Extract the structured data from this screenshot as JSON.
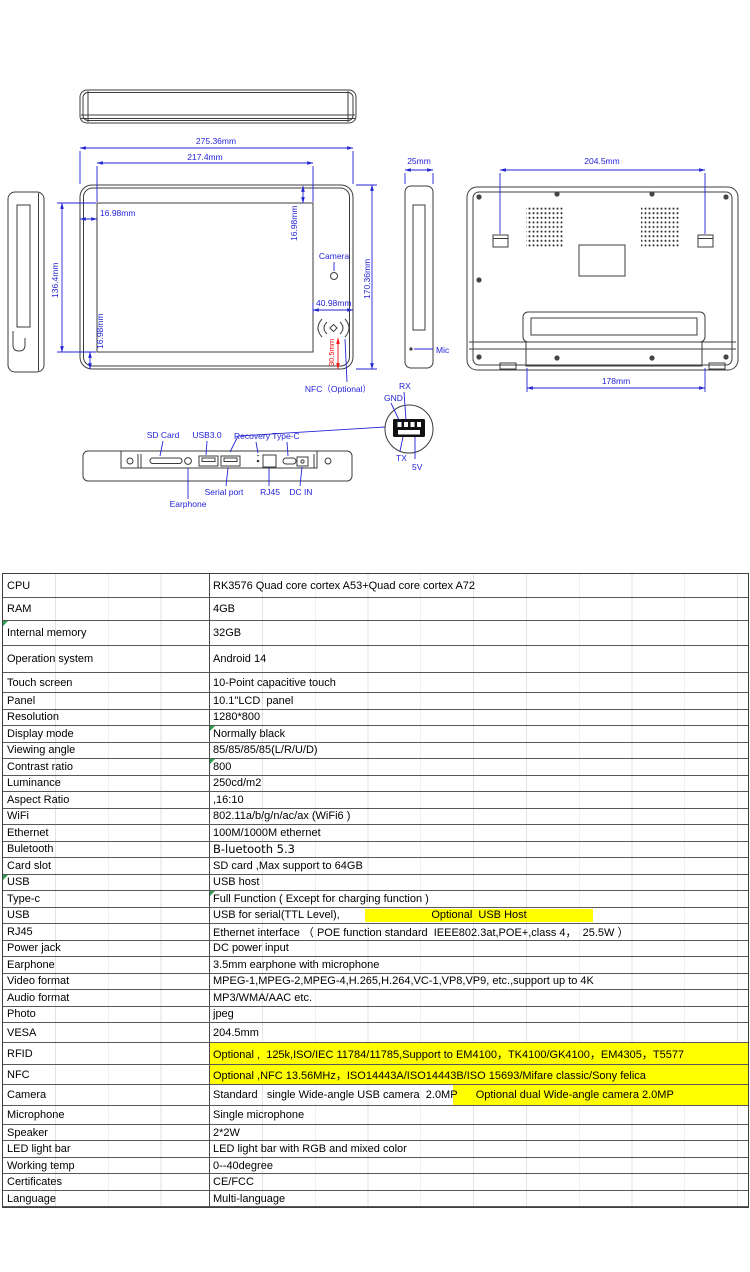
{
  "colors": {
    "dimension_blue": "#2323d8",
    "dimension_red": "#ee1111",
    "highlight_yellow": "#ffff00",
    "indicator_green": "#2f9e4f",
    "line_dark": "#3c3c3c"
  },
  "drawings": {
    "labels": {
      "dim_275": "275.36mm",
      "dim_217": "217.4mm",
      "dim_1698_a": "16.98mm",
      "dim_1698_b": "16.98mm",
      "dim_1698_c": "16.98mm",
      "dim_1364": "136.4mm",
      "dim_17036": "170.36mm",
      "camera": "Camera",
      "dim_4098": "40.98mm",
      "dim_305": "30.5mm",
      "nfc": "NFC（Optional）",
      "dim_25": "25mm",
      "dim_2045": "204.5mm",
      "dim_178": "178mm",
      "mic": "Mic",
      "rx": "RX",
      "gnd": "GND",
      "tx": "TX",
      "v5": "5V",
      "sd_card": "SD Card",
      "usb30": "USB3.0",
      "recovery": "Recovery",
      "type_c": "Type-C",
      "earphone": "Earphone",
      "serial_port": "Serial port",
      "rj45": "RJ45",
      "dc_in": "DC IN"
    }
  },
  "table": {
    "rows": [
      {
        "label": "CPU",
        "value": "RK3576 Quad core cortex A53+Quad core cortex A72",
        "h": 24
      },
      {
        "label": "RAM",
        "value": "4GB",
        "h": 23
      },
      {
        "label": "Internal memory",
        "value": "32GB",
        "h": 25,
        "green": "label"
      },
      {
        "label": "Operation system",
        "value": "Android 14",
        "h": 27
      },
      {
        "label": "Touch screen",
        "value": "10-Point capacitive touch",
        "h": 20
      },
      {
        "label": "Panel",
        "value": "10.1\"LCD  panel",
        "h": 16.5
      },
      {
        "label": "Resolution",
        "value": "1280*800",
        "h": 16.5
      },
      {
        "label": "Display mode",
        "value": "Normally black",
        "h": 16.5,
        "green": "value"
      },
      {
        "label": "Viewing angle",
        "value": "85/85/85/85(L/R/U/D)",
        "h": 16.5
      },
      {
        "label": "Contrast ratio",
        "value": "800",
        "h": 16.5,
        "green": "value"
      },
      {
        "label": "Luminance",
        "value": "250cd/m2",
        "h": 16.5
      },
      {
        "label": "Aspect Ratio",
        "value": ",16:10",
        "h": 16.5
      },
      {
        "label": "WiFi",
        "value": "802.11a/b/g/n/ac/ax (WiFi6 )",
        "h": 16.5
      },
      {
        "label": "Ethernet",
        "value": "100M/1000M ethernet",
        "h": 16.5
      },
      {
        "label": "Buletooth",
        "value": "B-luetooth 5.3",
        "h": 16.5,
        "alt": true
      },
      {
        "label": "Card slot",
        "value": "SD card ,Max support to 64GB",
        "h": 16.5
      },
      {
        "label": "USB",
        "value": "USB host",
        "h": 16.5,
        "green": "label"
      },
      {
        "label": "Type-c",
        "value": "Full Function ( Except for charging function )",
        "h": 16.5,
        "green": "value"
      },
      {
        "label": "USB",
        "value": "USB for serial(TTL Level),",
        "h": 16.5,
        "highlight": {
          "type": "block",
          "left": 155,
          "width": 228
        },
        "value2": "Optional  USB Host"
      },
      {
        "label": "RJ45",
        "value": "Ethernet interface （ POE function standard  IEEE802.3at,POE+,class 4，  25.5W ）",
        "h": 16.5
      },
      {
        "label": "Power jack",
        "value": "DC power input",
        "h": 16.5
      },
      {
        "label": "Earphone",
        "value": "3.5mm earphone with microphone",
        "h": 16.5
      },
      {
        "label": "Video format",
        "value": "MPEG-1,MPEG-2,MPEG-4,H.265,H.264,VC-1,VP8,VP9, etc.,support up to 4K",
        "h": 16.5
      },
      {
        "label": "Audio format",
        "value": "MP3/WMA/AAC etc.",
        "h": 16.5
      },
      {
        "label": "Photo",
        "value": "jpeg",
        "h": 16.5
      },
      {
        "label": "VESA",
        "value": "204.5mm",
        "h": 20
      },
      {
        "label": "RFID",
        "value": "Optional ,  125k,ISO/IEC 11784/11785,Support to EM4100，TK4100/GK4100，EM4305，T5577",
        "h": 22,
        "highlight": "full"
      },
      {
        "label": "NFC",
        "value": "Optional ,NFC 13.56MHz，ISO14443A/ISO14443B/ISO 15693/Mifare classic/Sony felica",
        "h": 20,
        "highlight": "full"
      },
      {
        "label": "Camera",
        "value": "Standard   single Wide-angle USB camera  2.0MP",
        "h": 21,
        "highlight": {
          "type": "tail",
          "left": 243
        },
        "value2": "Optional dual Wide-angle camera 2.0MP"
      },
      {
        "label": "Microphone",
        "value": "Single microphone",
        "h": 19
      },
      {
        "label": "Speaker",
        "value": "2*2W",
        "h": 16
      },
      {
        "label": "LED light bar",
        "value": "LED light bar with RGB and mixed color",
        "h": 17
      },
      {
        "label": "Working temp",
        "value": "0--40degree",
        "h": 16
      },
      {
        "label": "Certificates",
        "value": "CE/FCC",
        "h": 17
      },
      {
        "label": "Language",
        "value": "Multi-language",
        "h": 16
      }
    ]
  }
}
